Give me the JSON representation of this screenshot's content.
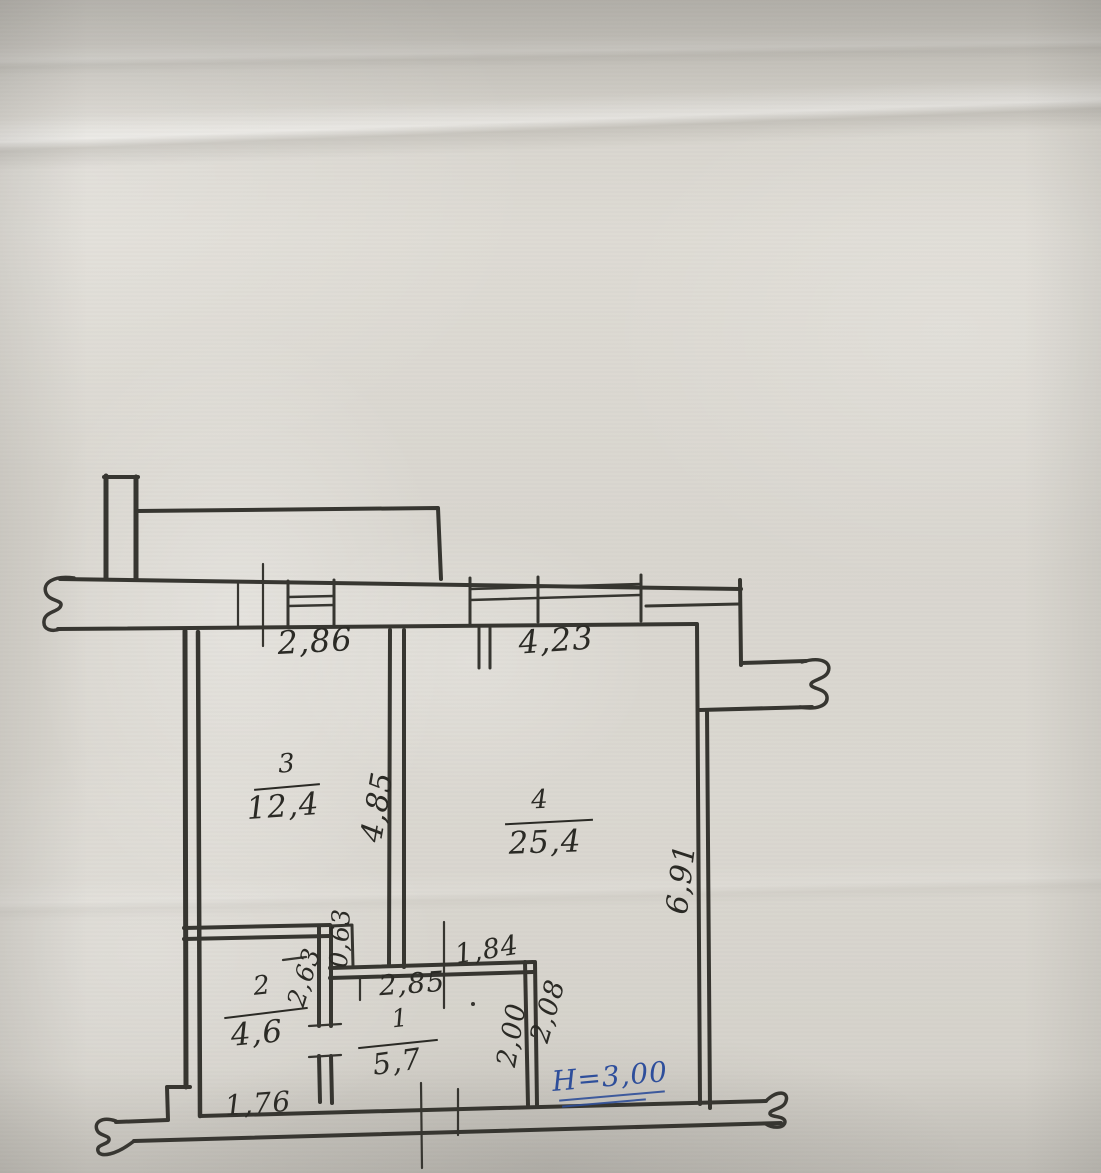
{
  "rooms": [
    {
      "number": "3",
      "area": "12,4"
    },
    {
      "number": "4",
      "area": "25,4"
    },
    {
      "number": "2",
      "area": "4,6"
    },
    {
      "number": "1",
      "area": "5,7"
    }
  ],
  "dimensions": {
    "top_left_width": "2,86",
    "top_right_width": "4,23",
    "room3_depth": "4,85",
    "right_side": "6,91",
    "niche": "0,63",
    "room2_side": "2,63",
    "hall_opening": "1,84",
    "hall_width": "2,85",
    "nook_inner": "2,00",
    "nook_outer": "2,08",
    "room2_width": "1,76"
  },
  "note": {
    "ceiling_height": "H=3,00"
  },
  "colors": {
    "ink": "#2b2a25",
    "pen": "#2e4f9d",
    "paper": "#d9d6cf"
  }
}
